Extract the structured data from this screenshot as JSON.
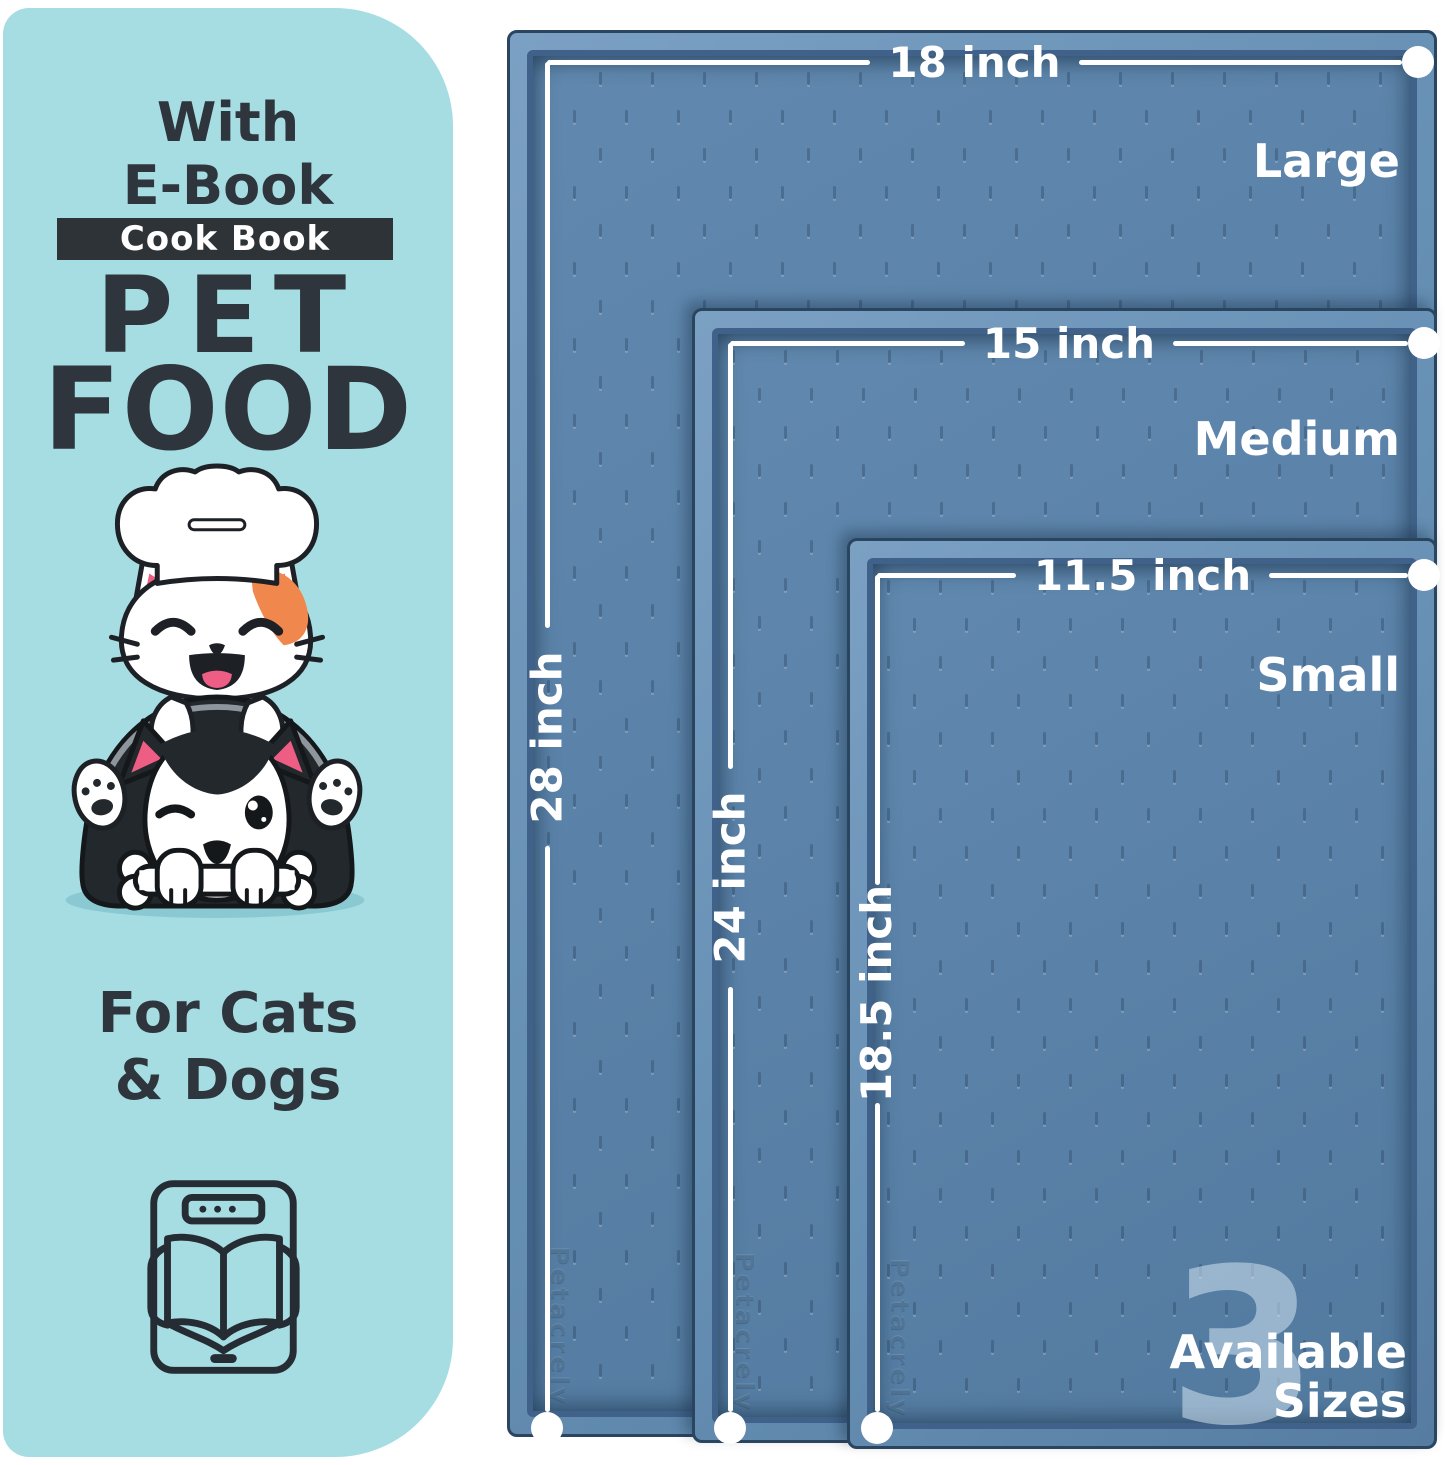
{
  "colors": {
    "panel_bg": "#a6dde3",
    "ink": "#2e353c",
    "banner_bg": "#2e3338",
    "mat_surface": "#5b83a9",
    "mat_rim": "#6f96b9",
    "mat_outline": "#2a4560",
    "line": "#ffffff"
  },
  "panel": {
    "top_line1": "With",
    "top_line2": "E-Book",
    "banner": "Cook Book",
    "title_line1": "PET",
    "title_line2": "FOOD",
    "subtitle_line1": "For Cats",
    "subtitle_line2": "& Dogs"
  },
  "mats": {
    "watermark": "Petacrely",
    "sizes": [
      {
        "name": "Large",
        "width_label": "18 inch",
        "height_label": "28 inch"
      },
      {
        "name": "Medium",
        "width_label": "15 inch",
        "height_label": "24 inch"
      },
      {
        "name": "Small",
        "width_label": "11.5 inch",
        "height_label": "18.5 inch"
      }
    ]
  },
  "badge": {
    "count": "3",
    "line1": "Available",
    "line2": "Sizes"
  }
}
